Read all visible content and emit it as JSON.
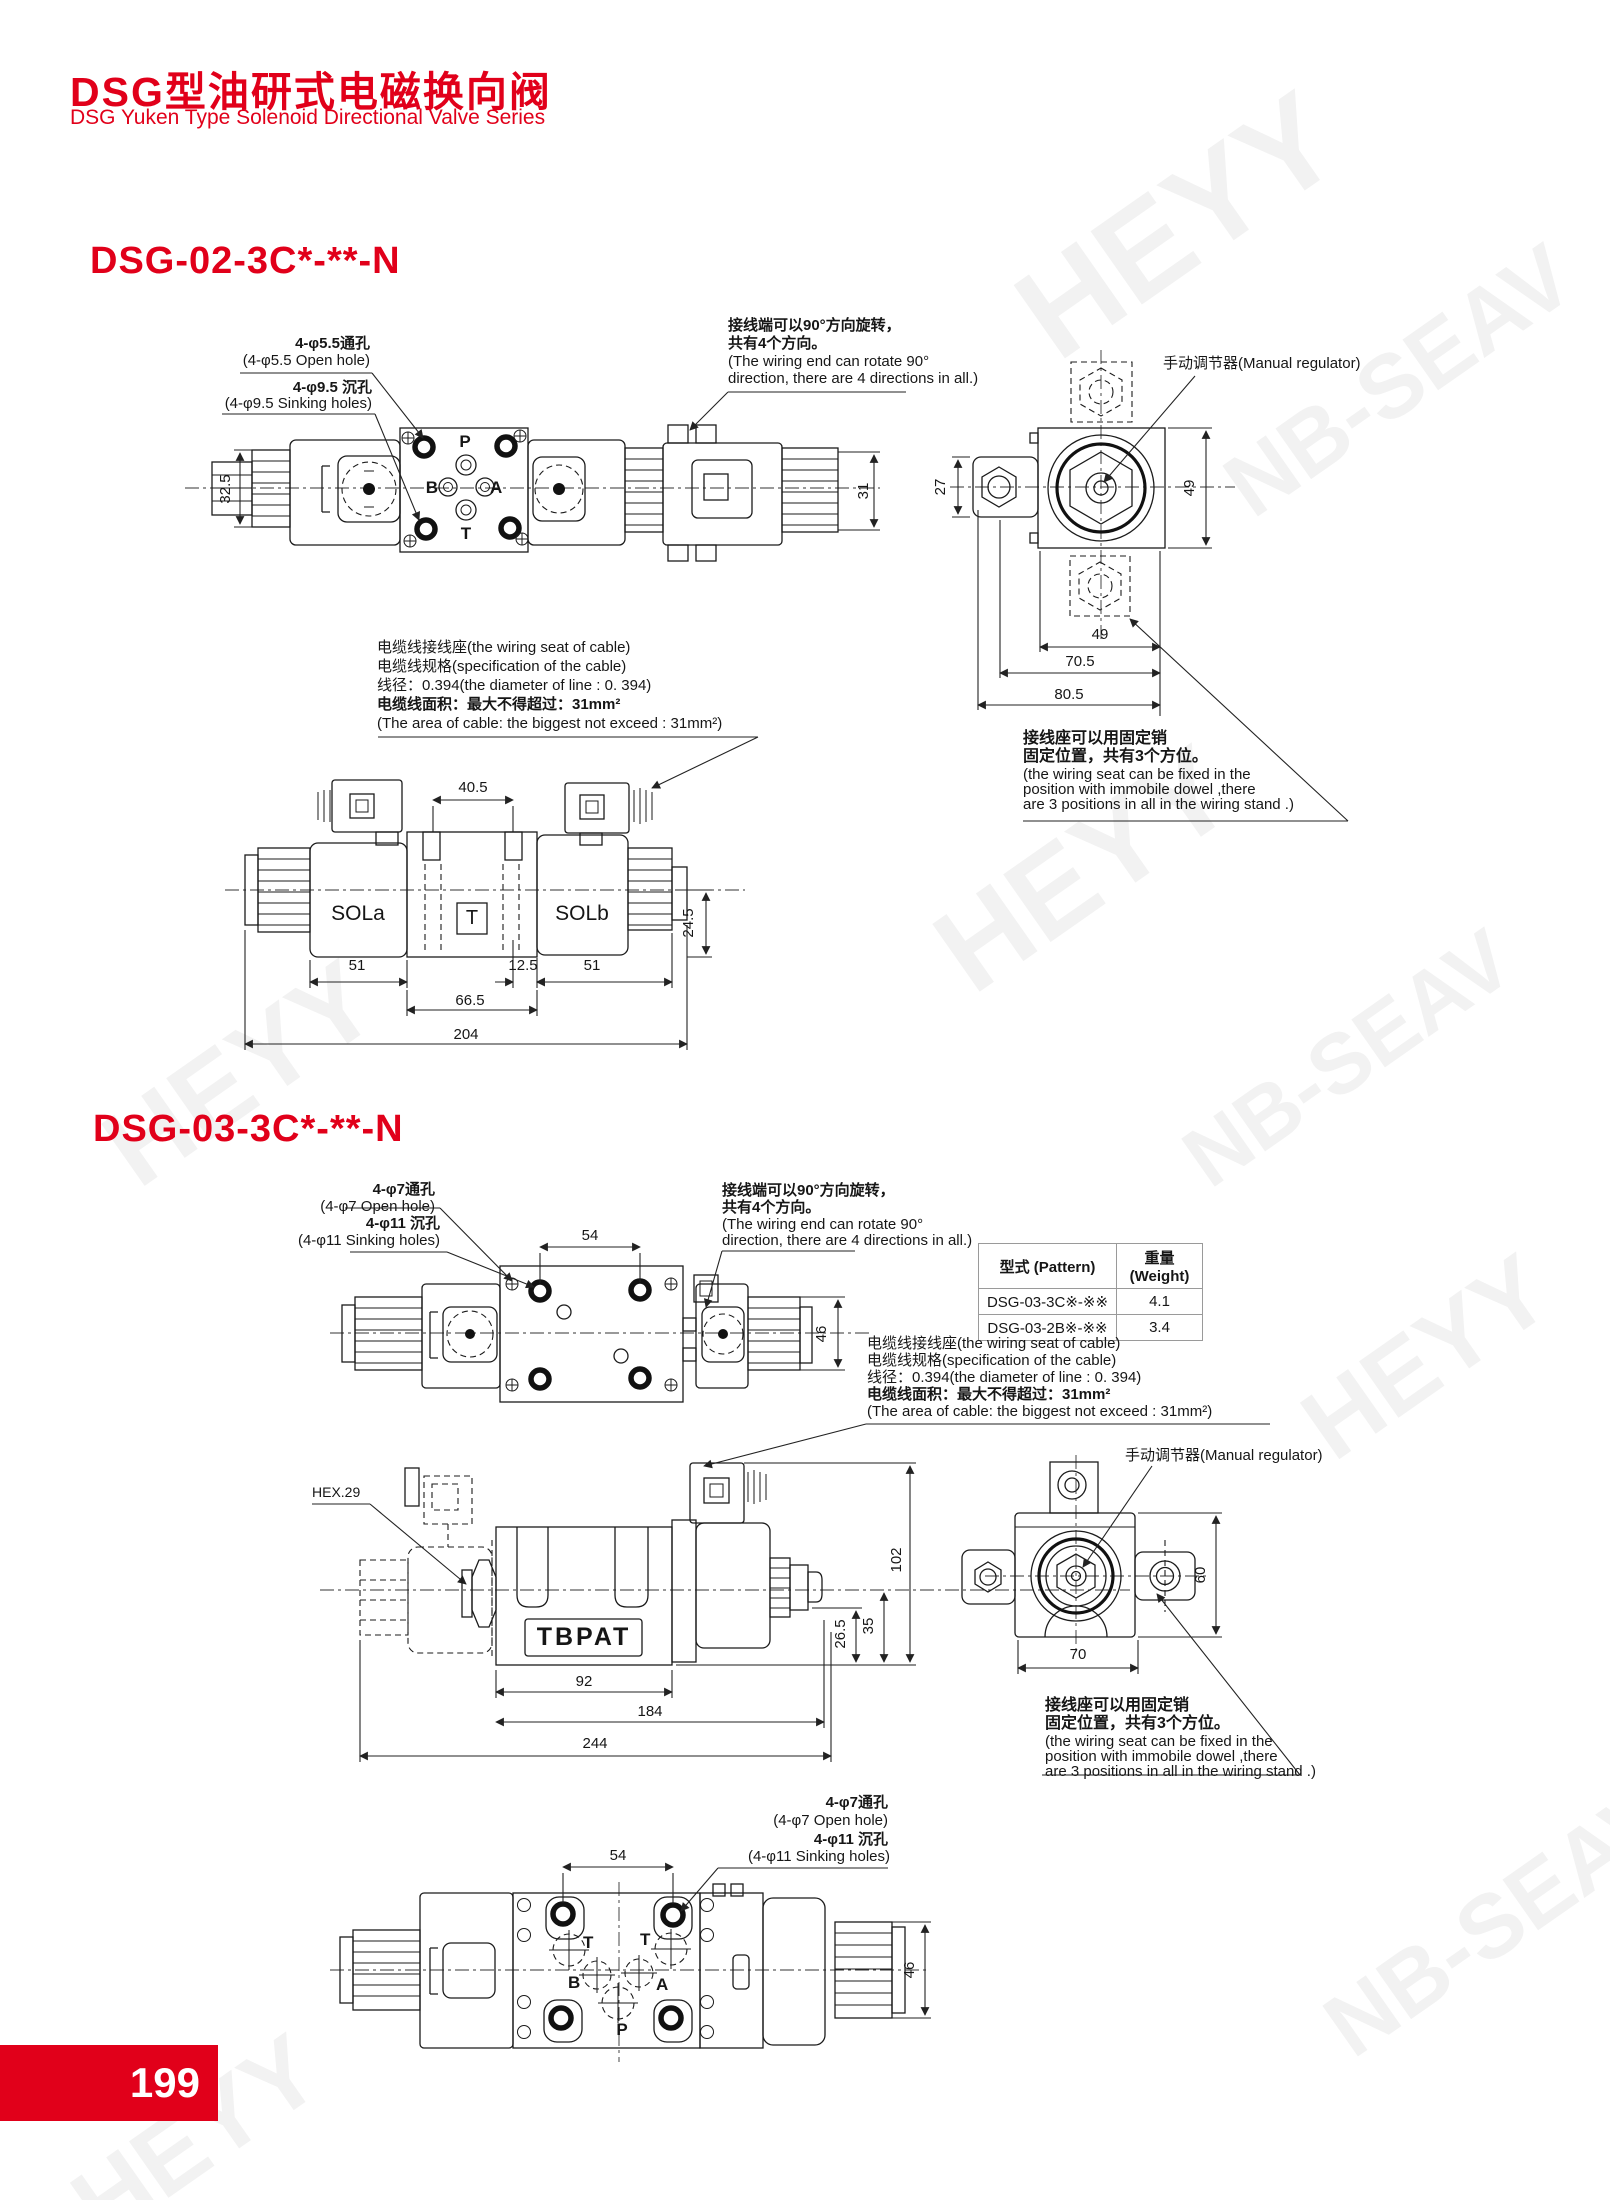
{
  "header": {
    "title_zh": "DSG型油研式电磁换向阀",
    "title_en": "DSG Yuken Type Solenoid Directional Valve Series"
  },
  "colors": {
    "accent": "#e1001a",
    "line": "#1b1b1b"
  },
  "shared": {
    "rotate_zh1": "接线端可以90°方向旋转，",
    "rotate_zh2": "共有4个方向。",
    "rotate_en1": "(The wiring end can rotate 90°",
    "rotate_en2": "direction, there are 4 directions in all.)",
    "cable1": "电缆线接线座(the wiring seat of cable)",
    "cable2": "电缆线规格(specification of the cable)",
    "cable3": "线径：0.394(the diameter of line : 0. 394)",
    "cable4": "电缆线面积：最大不得超过：31mm²",
    "cable5": "(The area of cable: the biggest not exceed : 31mm²)",
    "manual_regulator": "手动调节器(Manual regulator)",
    "wiring_zh1": "接线座可以用固定销",
    "wiring_zh2": "固定位置，共有3个方位。",
    "wiring_en1": "(the wiring seat can be fixed in the",
    "wiring_en2": "position with immobile dowel ,there",
    "wiring_en3": "are 3 positions in all in the wiring stand .)"
  },
  "s1": {
    "title": "DSG-02-3C*-**-N",
    "open_zh": "4-φ5.5通孔",
    "open_en": "(4-φ5.5 Open hole)",
    "sink_zh": "4-φ9.5 沉孔",
    "sink_en": "(4-φ9.5 Sinking holes)",
    "port_p": "P",
    "port_a": "A",
    "port_b": "B",
    "port_t": "T",
    "sola": "SOLa",
    "tbox": "T",
    "solb": "SOLb",
    "d32_5": "32.5",
    "d31": "31",
    "d40_5": "40.5",
    "d51a": "51",
    "d12_5": "12.5",
    "d51b": "51",
    "d66_5": "66.5",
    "d204": "204",
    "d24_5": "24.5",
    "d27": "27",
    "d49v": "49",
    "d49h": "49",
    "d70_5": "70.5",
    "d80_5": "80.5"
  },
  "s2": {
    "title": "DSG-03-3C*-**-N",
    "open_zh": "4-φ7通孔",
    "open_en": "(4-φ7 Open hole)",
    "sink_zh": "4-φ11 沉孔",
    "sink_en": "(4-φ11 Sinking holes)",
    "hex": "HEX.29",
    "tbpat": "TBPAT",
    "t1": "T",
    "t2": "T",
    "b": "B",
    "a": "A",
    "p": "P",
    "d54t": "54",
    "d46t": "46",
    "d102": "102",
    "d35": "35",
    "d26_5": "26.5",
    "d92": "92",
    "d184": "184",
    "d244": "244",
    "d60": "60",
    "d70": "70",
    "d54b": "54",
    "d46b": "46",
    "table": {
      "col1": "型式 (Pattern)",
      "col2": "重量(Weight)",
      "rows": [
        {
          "pattern": "DSG-03-3C※-※※",
          "weight": "4.1"
        },
        {
          "pattern": "DSG-03-2B※-※※",
          "weight": "3.4"
        }
      ]
    }
  },
  "footer": {
    "page_number": "199"
  },
  "watermark": {
    "w1": "HEYY",
    "w2": "NB-SEAV"
  }
}
